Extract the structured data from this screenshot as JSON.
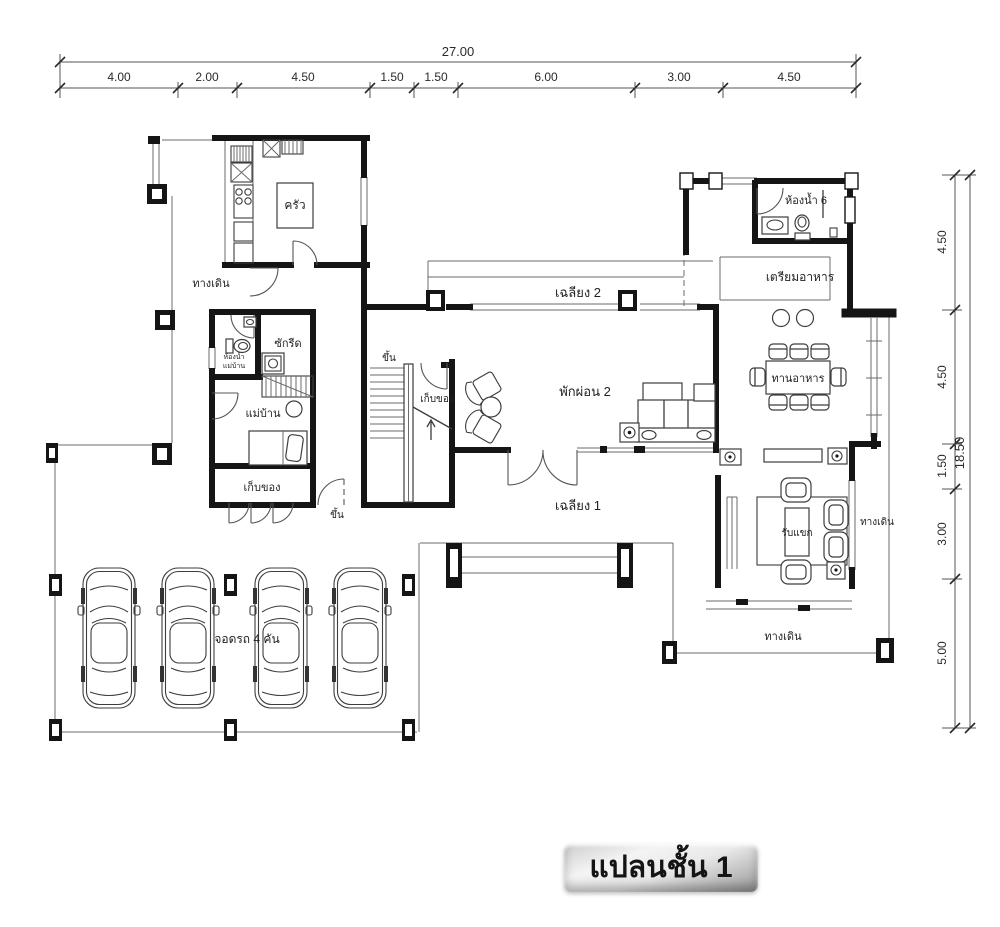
{
  "banner": {
    "label": "แปลนชั้น 1"
  },
  "dimensions": {
    "top": {
      "total": "27.00",
      "segments": [
        "4.00",
        "2.00",
        "4.50",
        "1.50",
        "1.50",
        "6.00",
        "3.00",
        "4.50"
      ]
    },
    "right": {
      "total": "18.50",
      "segments": [
        "4.50",
        "4.50",
        "1.50",
        "3.00",
        "5.00"
      ]
    }
  },
  "labels": {
    "kitchen": "ครัว",
    "walkway": "ทางเดิน",
    "porch2": "เฉลียง 2",
    "bath6": "ห้องน้ำ 6",
    "food_prep": "เตรียมอาหาร",
    "laundry": "ซักรีด",
    "maid_bath_1": "ห้องน้ำ",
    "maid_bath_2": "แม่บ้าน",
    "maid": "แม่บ้าน",
    "storage": "เก็บของ",
    "stair_storage": "เก็บของ",
    "up": "ขึ้น",
    "up2": "ขึ้น",
    "dining": "ทานอาหาร",
    "lounge": "พักผ่อน 2",
    "porch1": "เฉลียง 1",
    "living": "รับแขก",
    "carpark": "จอดรถ 4 คัน",
    "walkway_right": "ทางเดิน",
    "walkway_bottom": "ทางเดิน"
  },
  "colors": {
    "wall": "#151515",
    "thin_line": "#6b6b6b",
    "furniture": "#3d3d3d",
    "text": "#1f1f1f",
    "banner_light": "#f4f4f4",
    "banner_dark": "#979797"
  }
}
